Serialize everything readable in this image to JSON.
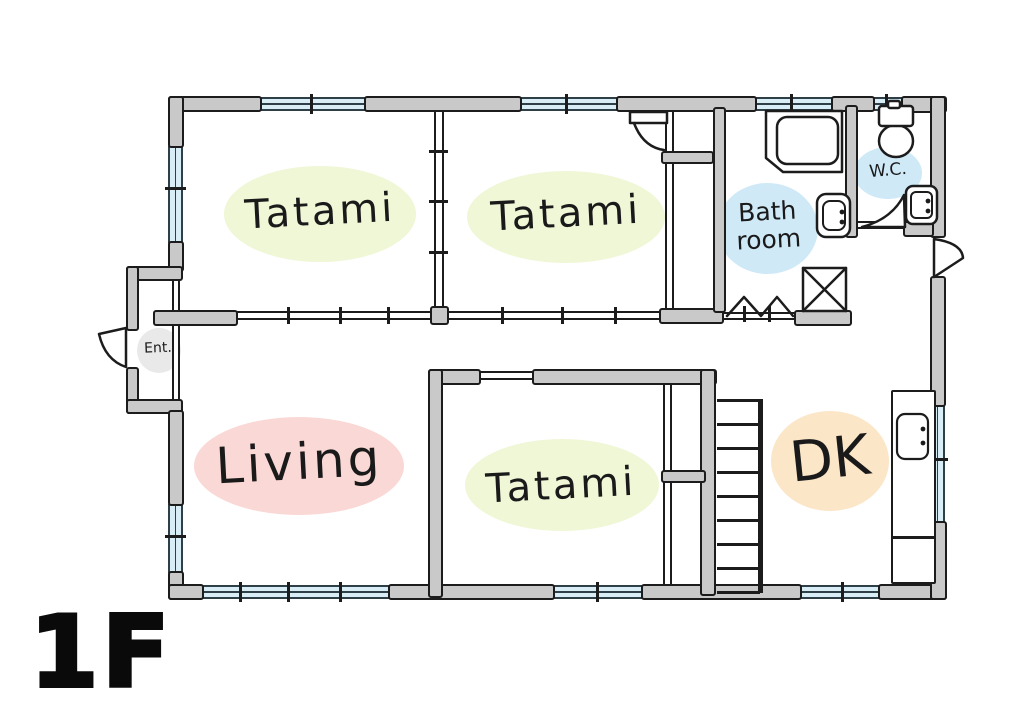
{
  "floor": {
    "label": "1F"
  },
  "rooms": {
    "tatami_nw": {
      "label": "Tatami"
    },
    "tatami_ne": {
      "label": "Tatami"
    },
    "tatami_s": {
      "label": "Tatami"
    },
    "living": {
      "label": "Living"
    },
    "dk": {
      "label": "DK"
    },
    "bath": {
      "label": "Bath\nroom"
    },
    "wc": {
      "label": "W.C."
    },
    "entrance": {
      "label": "Ent."
    }
  },
  "colors": {
    "wall-fill": "#c9c9c9",
    "line": "#1c1c1c",
    "window-glass": "#d9edf6",
    "window-frame": "#2e3f47",
    "tatami-blob": "#eff7d6",
    "living-blob": "#fad8d5",
    "dk-blob": "#fce6c8",
    "water-blob": "#cfe9f7",
    "ent-blob": "#e9e9e9",
    "label-ink": "#1a1a1a",
    "floor-label-ink": "#0a0a0a"
  },
  "fixtures": [
    "bathtub",
    "toilet",
    "wc-sink",
    "bathroom-sink",
    "washing-machine",
    "kitchen-sink",
    "kitchen-counter",
    "stairs",
    "entrance-door",
    "closet-door",
    "wc-door",
    "back-door",
    "folding-door"
  ]
}
